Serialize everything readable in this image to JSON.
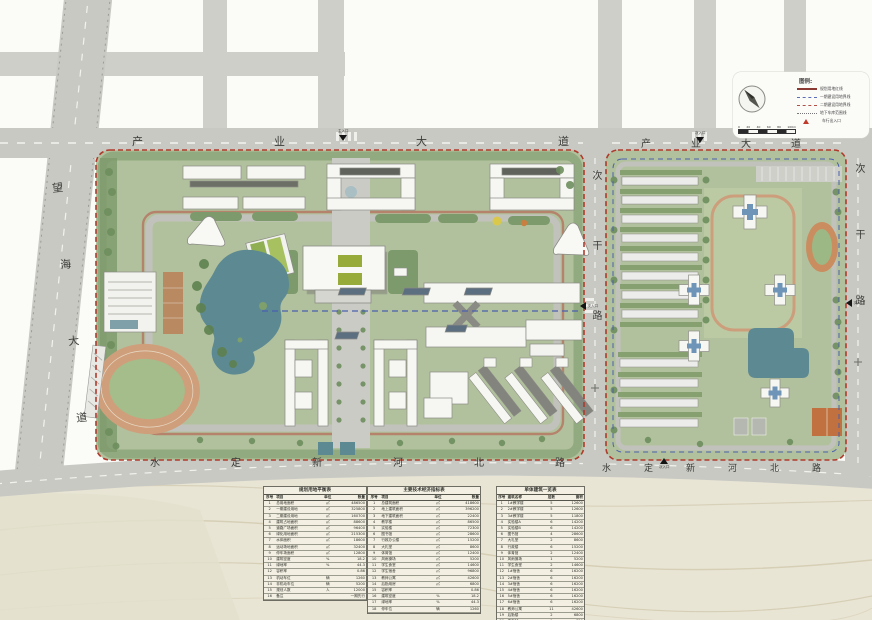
{
  "plan": {
    "type": "campus-master-plan"
  },
  "roads": {
    "top_left": "产业大道",
    "top_right": "产业大道",
    "left_diagonal": "望海大道",
    "middle_vertical": "次干路",
    "right_vertical": "次干路",
    "bottom_left": "水定新河北路",
    "bottom_right": "水定新河北路"
  },
  "legend": {
    "title": "图例:",
    "items": [
      {
        "type": "solid",
        "label": "规划用地红线"
      },
      {
        "type": "dashblue",
        "label": "一期建设用地界线"
      },
      {
        "type": "dashred",
        "label": "二期建设用地界线"
      },
      {
        "type": "dot",
        "label": "地下车库范围线"
      },
      {
        "type": "tri",
        "label": "车行出入口"
      }
    ],
    "scale": {
      "ticks": [
        "0",
        "20",
        "40",
        "60",
        "80",
        "100m"
      ]
    }
  },
  "entrances": [
    {
      "label": "主入口"
    },
    {
      "label": "次入口"
    },
    {
      "label": "次入口"
    },
    {
      "label": "次入口"
    },
    {
      "label": "次入口"
    },
    {
      "label": "次入口"
    }
  ],
  "colors": {
    "boundary_red": "#b03a2c",
    "phase_blue": "#4a5fae",
    "campus_green": "#b2c19d",
    "tree_green": "#7c9a6a",
    "water_teal": "#5d8a92",
    "road_gray": "#c9c9c4",
    "track_tan": "#cf9f7c",
    "land_beige": "#e9e5d5"
  },
  "tables": [
    {
      "title": "规划用地平衡表",
      "cols": [
        "序号",
        "项目",
        "单位",
        "数量"
      ],
      "rows": [
        [
          "1",
          "总用地面积",
          "㎡",
          "486500"
        ],
        [
          "2",
          "一期建设用地",
          "㎡",
          "325800"
        ],
        [
          "3",
          "二期建设用地",
          "㎡",
          "160700"
        ],
        [
          "4",
          "建筑占地面积",
          "㎡",
          "88600"
        ],
        [
          "5",
          "道路广场面积",
          "㎡",
          "96400"
        ],
        [
          "6",
          "绿化用地面积",
          "㎡",
          "215300"
        ],
        [
          "7",
          "水体面积",
          "㎡",
          "18600"
        ],
        [
          "8",
          "运动场地面积",
          "㎡",
          "32400"
        ],
        [
          "9",
          "停车场面积",
          "㎡",
          "12800"
        ],
        [
          "10",
          "建筑密度",
          "%",
          "18.2"
        ],
        [
          "11",
          "绿地率",
          "%",
          "44.3"
        ],
        [
          "12",
          "容积率",
          "",
          "0.86"
        ],
        [
          "13",
          "机动车位",
          "辆",
          "1260"
        ],
        [
          "14",
          "非机动车位",
          "辆",
          "5200"
        ],
        [
          "15",
          "规划人数",
          "人",
          "12000"
        ],
        [
          "16",
          "备注",
          "",
          "一期先行"
        ]
      ]
    },
    {
      "title": "主要技术经济指标表",
      "cols": [
        "序号",
        "项目",
        "单位",
        "数量"
      ],
      "rows": [
        [
          "1",
          "总建筑面积",
          "㎡",
          "418600"
        ],
        [
          "2",
          "地上建筑面积",
          "㎡",
          "396200"
        ],
        [
          "3",
          "地下建筑面积",
          "㎡",
          "22400"
        ],
        [
          "4",
          "教学楼",
          "㎡",
          "86500"
        ],
        [
          "5",
          "实验楼",
          "㎡",
          "72300"
        ],
        [
          "6",
          "图书馆",
          "㎡",
          "28600"
        ],
        [
          "7",
          "行政办公楼",
          "㎡",
          "15200"
        ],
        [
          "8",
          "大礼堂",
          "㎡",
          "8600"
        ],
        [
          "9",
          "体育馆",
          "㎡",
          "12400"
        ],
        [
          "10",
          "风雨操场",
          "㎡",
          "5200"
        ],
        [
          "11",
          "学生食堂",
          "㎡",
          "14600"
        ],
        [
          "12",
          "学生宿舍",
          "㎡",
          "96800"
        ],
        [
          "13",
          "教师公寓",
          "㎡",
          "42600"
        ],
        [
          "14",
          "后勤用房",
          "㎡",
          "6800"
        ],
        [
          "15",
          "容积率",
          "",
          "0.86"
        ],
        [
          "16",
          "建筑密度",
          "%",
          "18.2"
        ],
        [
          "17",
          "绿地率",
          "%",
          "44.3"
        ],
        [
          "18",
          "停车位",
          "辆",
          "1260"
        ]
      ]
    },
    {
      "title": "单体建筑一览表",
      "cols": [
        "序号",
        "建筑名称",
        "层数",
        "面积"
      ],
      "rows": [
        [
          "1",
          "1#教学楼",
          "5",
          "12600"
        ],
        [
          "2",
          "2#教学楼",
          "5",
          "12600"
        ],
        [
          "3",
          "3#教学楼",
          "5",
          "11800"
        ],
        [
          "4",
          "实验楼A",
          "6",
          "14200"
        ],
        [
          "5",
          "实验楼B",
          "6",
          "14200"
        ],
        [
          "6",
          "图书馆",
          "4",
          "28600"
        ],
        [
          "7",
          "大礼堂",
          "2",
          "8600"
        ],
        [
          "8",
          "行政楼",
          "6",
          "15200"
        ],
        [
          "9",
          "体育馆",
          "2",
          "12400"
        ],
        [
          "10",
          "风雨操场",
          "1",
          "5200"
        ],
        [
          "11",
          "学生食堂",
          "2",
          "14600"
        ],
        [
          "12",
          "1#宿舍",
          "6",
          "16200"
        ],
        [
          "13",
          "2#宿舍",
          "6",
          "16200"
        ],
        [
          "14",
          "3#宿舍",
          "6",
          "16200"
        ],
        [
          "15",
          "4#宿舍",
          "6",
          "16200"
        ],
        [
          "16",
          "5#宿舍",
          "6",
          "16200"
        ],
        [
          "17",
          "6#宿舍",
          "6",
          "16200"
        ],
        [
          "18",
          "教师公寓",
          "11",
          "42600"
        ],
        [
          "19",
          "后勤楼",
          "2",
          "6800"
        ],
        [
          "20",
          "变电站",
          "1",
          "850"
        ],
        [
          "21",
          "门卫室",
          "1",
          "120"
        ],
        [
          "22",
          "合计",
          "",
          "316000"
        ]
      ]
    }
  ]
}
